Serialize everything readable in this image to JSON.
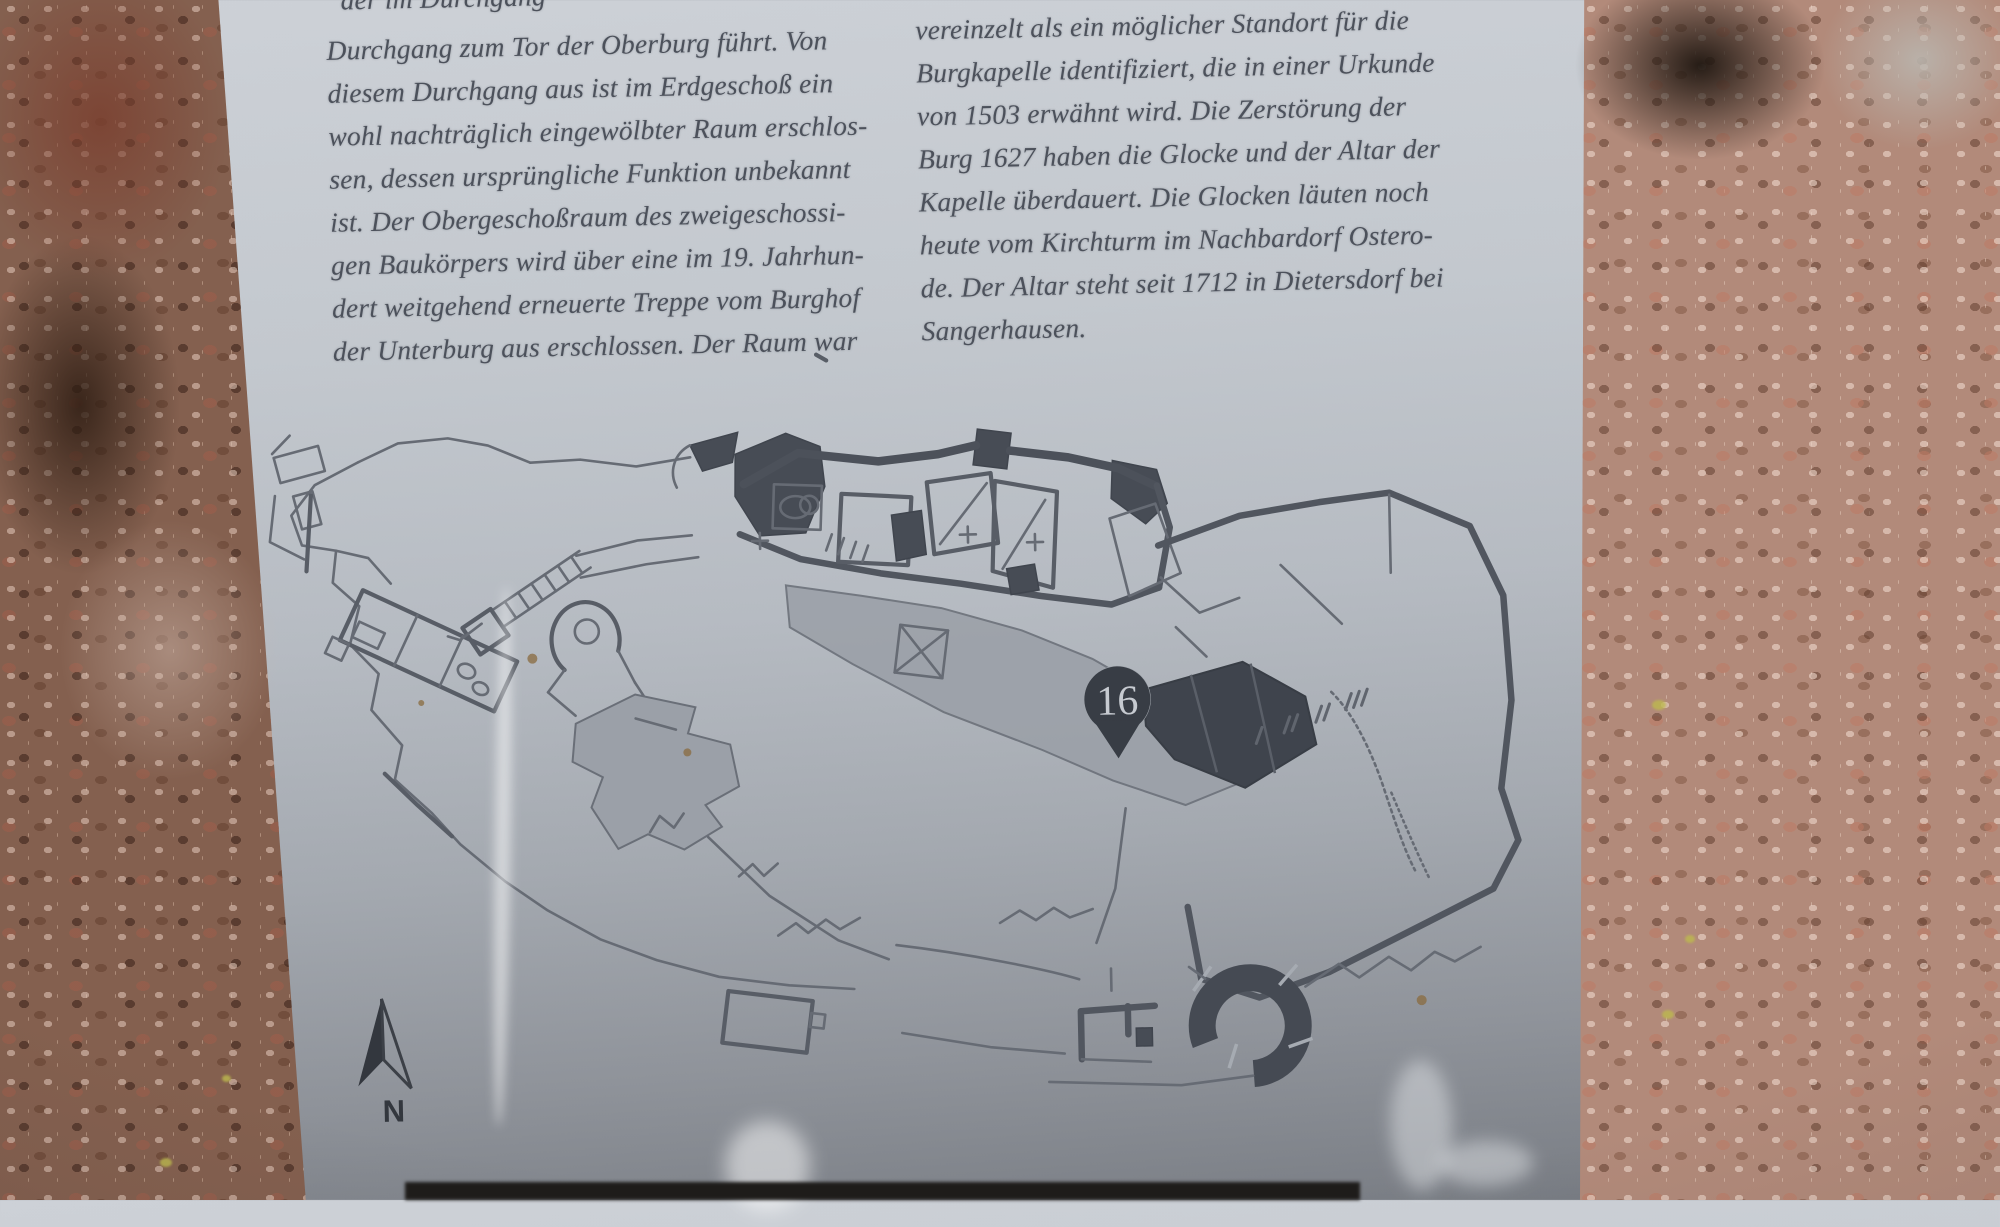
{
  "panel": {
    "partial_top_line": "der im Durchgang",
    "left_column": {
      "lines": [
        "Durchgang zum Tor der Oberburg führt. Von",
        "diesem Durchgang aus ist im Erdgeschoß ein",
        "wohl nachträglich eingewölbter Raum erschlos-",
        "sen, dessen ursprüngliche Funktion unbekannt",
        "ist. Der Obergeschoßraum des zweigeschossi-",
        "gen Baukörpers wird über eine im 19. Jahrhun-",
        "dert weitgehend erneuerte Treppe vom Burghof",
        "der Unterburg aus erschlossen. Der Raum war"
      ]
    },
    "right_column": {
      "lines": [
        "vereinzelt als ein möglicher Standort für die",
        "Burgkapelle identifiziert, die in einer Urkunde",
        "von 1503 erwähnt wird. Die Zerstörung der",
        "Burg 1627 haben die Glocke und der Altar der",
        "Kapelle überdauert. Die Glocken läuten noch",
        "heute vom Kirchturm im Nachbardorf Ostero-",
        "de. Der Altar steht seit 1712 in Dietersdorf bei",
        "Sangerhausen."
      ]
    },
    "map": {
      "marker_label": "16",
      "north_label": "N"
    }
  },
  "colors": {
    "plate": "#bfc4ca",
    "engraved_text": "#4c515b",
    "map_line": "#5d626b",
    "map_dark_fill": "#474c55",
    "map_gray_fill": "#9ba0a8",
    "marker_pin": "#383d45",
    "marker_text": "#c6cad0",
    "rock_left": "#84604f",
    "rock_right": "#b28a7a",
    "lichen": "#bdb94e",
    "bottom_strip": "#1e1c1a"
  }
}
